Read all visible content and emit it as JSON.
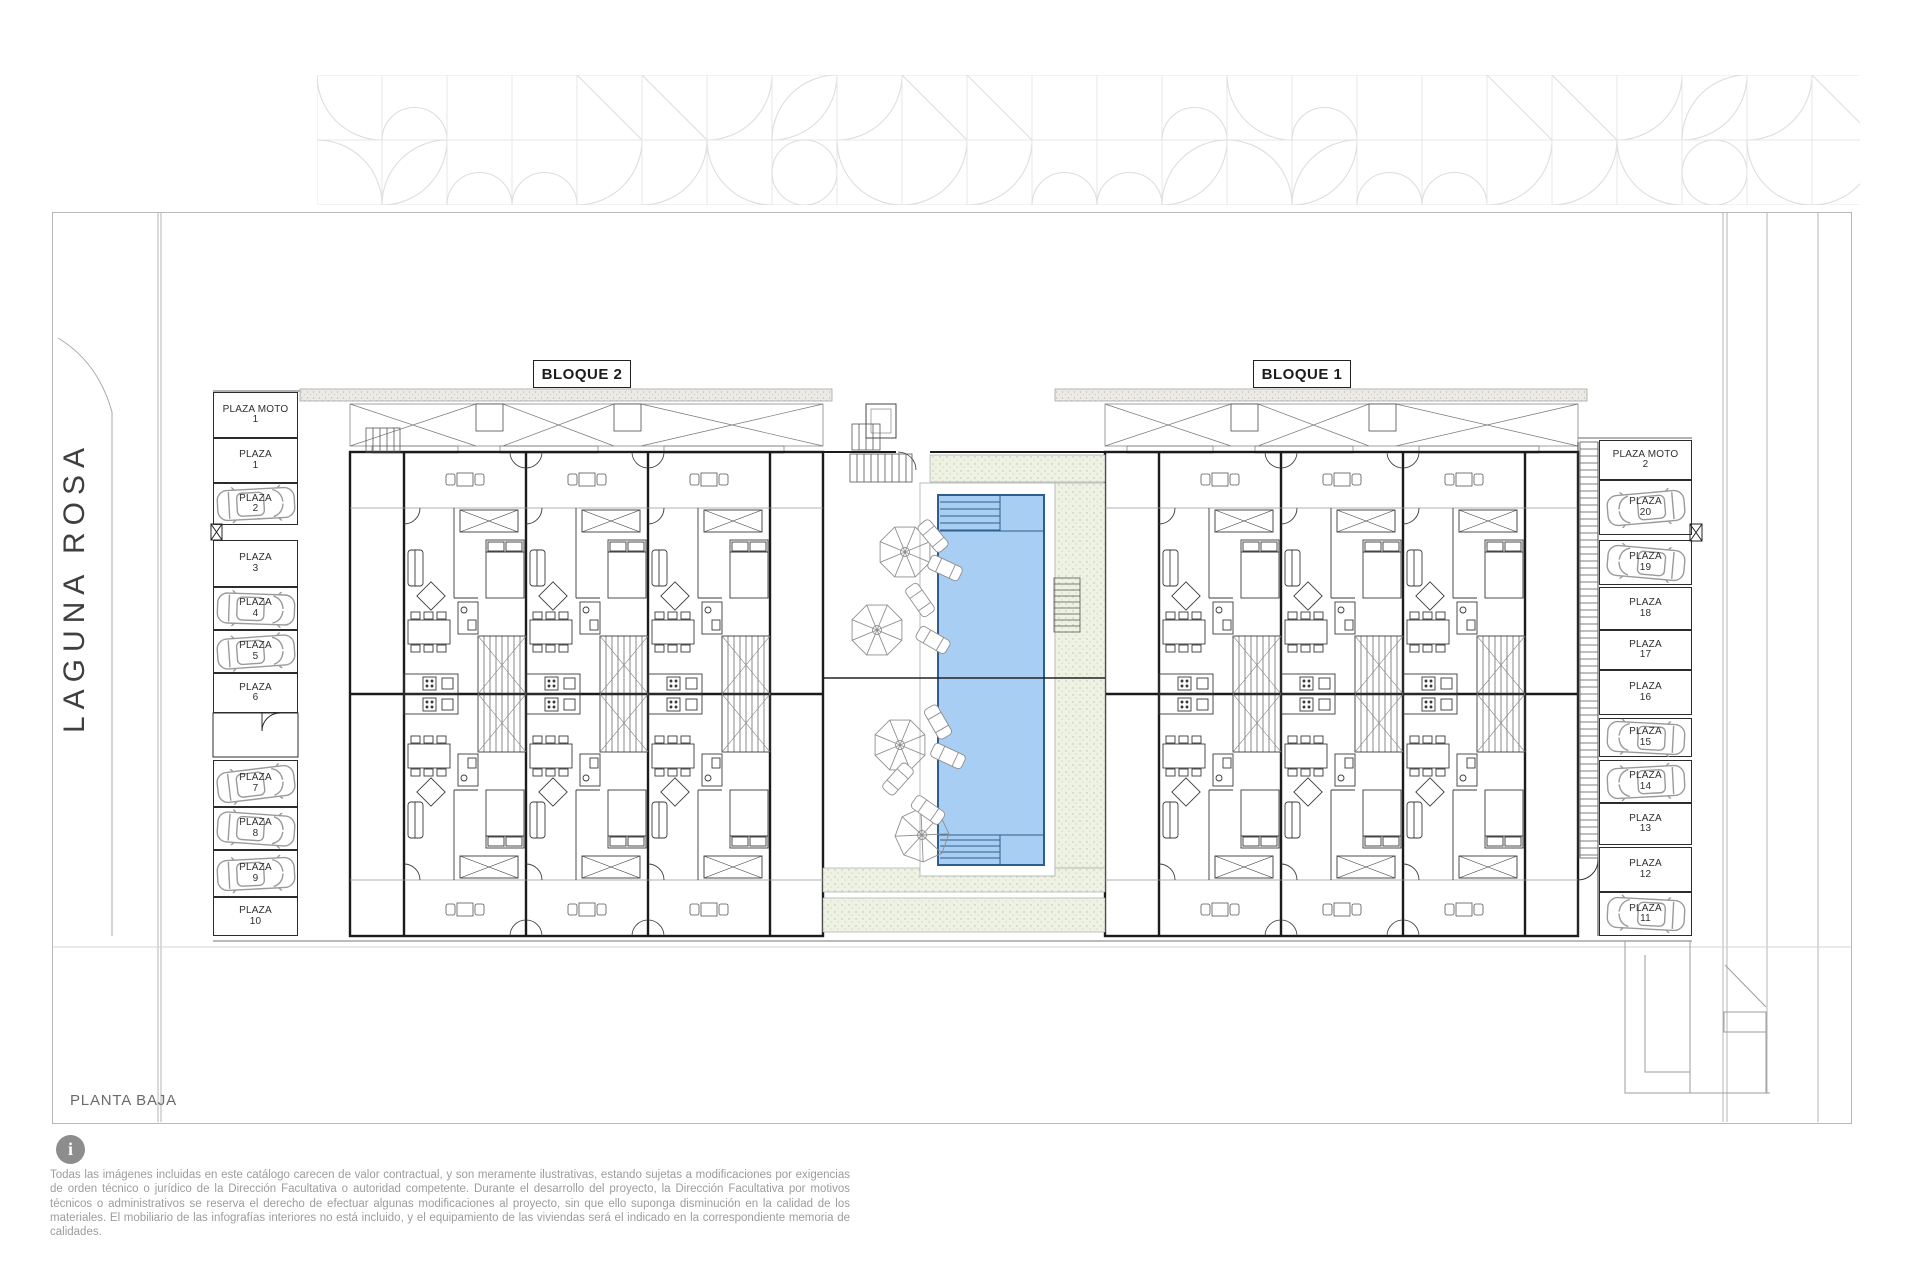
{
  "plan": {
    "street_name": "LAGUNA ROSA",
    "floor_label": "PLANTA BAJA",
    "blocks": [
      {
        "label": "BLOQUE 2"
      },
      {
        "label": "BLOQUE 1"
      }
    ]
  },
  "parking": {
    "left": {
      "stalls": [
        {
          "name": "PLAZA MOTO",
          "num": "1",
          "car": false,
          "tilt": 0
        },
        {
          "name": "PLAZA",
          "num": "1",
          "car": false,
          "tilt": 0
        },
        {
          "name": "PLAZA",
          "num": "2",
          "car": true,
          "tilt": -3
        },
        {
          "name": "PLAZA",
          "num": "3",
          "car": false,
          "tilt": 0
        },
        {
          "name": "PLAZA",
          "num": "4",
          "car": true,
          "tilt": 2
        },
        {
          "name": "PLAZA",
          "num": "5",
          "car": true,
          "tilt": -4
        },
        {
          "name": "PLAZA",
          "num": "6",
          "car": false,
          "tilt": 0
        },
        {
          "name": "PLAZA",
          "num": "7",
          "car": true,
          "tilt": -7
        },
        {
          "name": "PLAZA",
          "num": "8",
          "car": true,
          "tilt": 4
        },
        {
          "name": "PLAZA",
          "num": "9",
          "car": true,
          "tilt": -3
        },
        {
          "name": "PLAZA",
          "num": "10",
          "car": false,
          "tilt": 0
        }
      ]
    },
    "right": {
      "stalls": [
        {
          "name": "PLAZA MOTO",
          "num": "2",
          "car": false,
          "tilt": 0
        },
        {
          "name": "PLAZA",
          "num": "20",
          "car": true,
          "tilt": -5
        },
        {
          "name": "PLAZA",
          "num": "19",
          "car": true,
          "tilt": 5
        },
        {
          "name": "PLAZA",
          "num": "18",
          "car": false,
          "tilt": 0
        },
        {
          "name": "PLAZA",
          "num": "17",
          "car": false,
          "tilt": 0
        },
        {
          "name": "PLAZA",
          "num": "16",
          "car": false,
          "tilt": 0
        },
        {
          "name": "PLAZA",
          "num": "15",
          "car": true,
          "tilt": 3
        },
        {
          "name": "PLAZA",
          "num": "14",
          "car": true,
          "tilt": -3
        },
        {
          "name": "PLAZA",
          "num": "13",
          "car": false,
          "tilt": 0
        },
        {
          "name": "PLAZA",
          "num": "12",
          "car": false,
          "tilt": 0
        },
        {
          "name": "PLAZA",
          "num": "11",
          "car": true,
          "tilt": 3
        }
      ]
    }
  },
  "disclaimer": {
    "text": "Todas las imágenes incluidas en este catálogo carecen de valor contractual, y son meramente ilustrativas, estando sujetas a modificaciones por exigencias de orden técnico o jurídico de la Dirección Facultativa o autoridad competente. Durante el desarrollo del proyecto, la Dirección Facultativa por motivos técnicos o administrativos se reserva el derecho de efectuar algunas modificaciones al proyecto, sin que ello suponga disminución en la calidad de los materiales. El mobiliario de las infografías interiores no está incluido, y el equipamiento de las viviendas será el indicado en la correspondiente memoria de calidades."
  },
  "colors": {
    "pool_water": "#a9cef3",
    "pool_edge": "#2e5d8e",
    "deck_green": "#edf2e3",
    "canopy_grit": "#eceae4",
    "line_dark": "#1b1b1b",
    "text_gray": "#9c9c9c"
  }
}
